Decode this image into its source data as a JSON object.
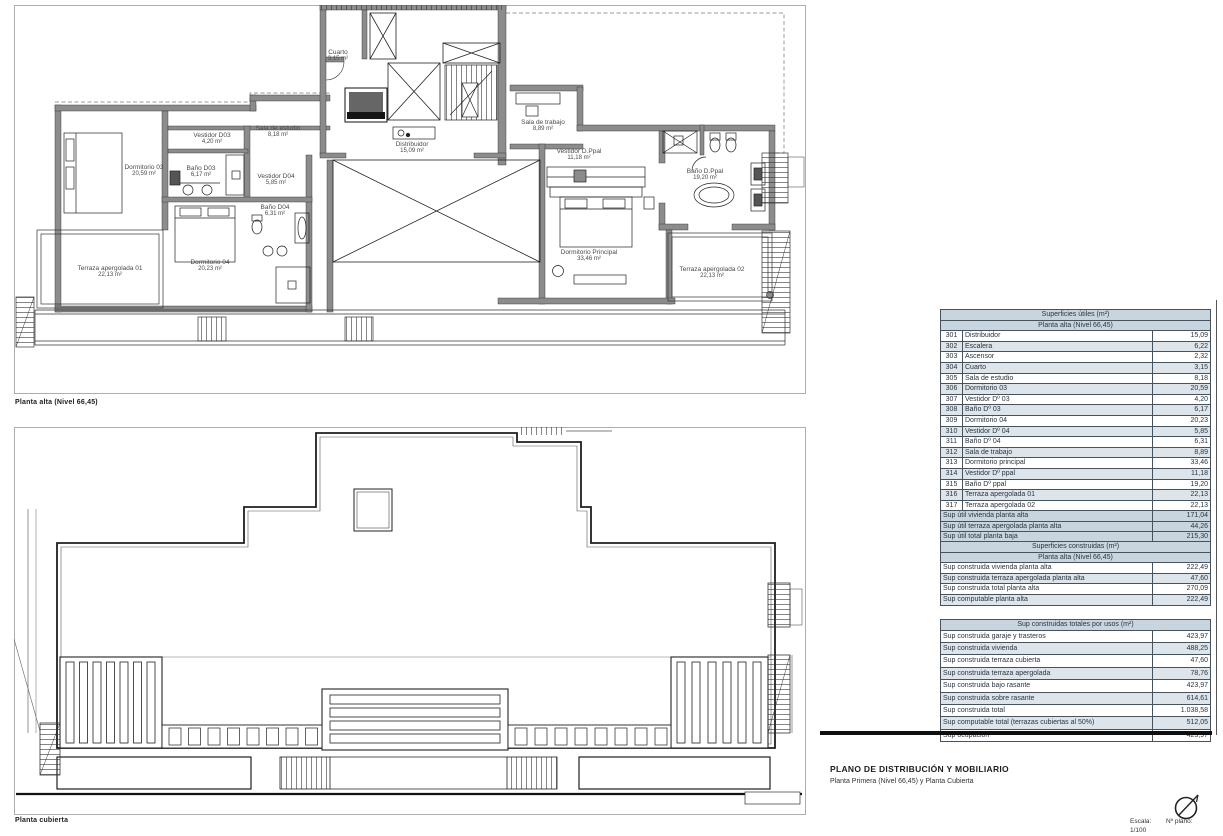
{
  "document": {
    "title": "PLANO DE DISTRIBUCIÓN Y MOBILIARIO",
    "subtitle": "Planta Primera (Nivel 66,45) y Planta Cubierta",
    "scale_label": "Escala:",
    "scale_value": "1/100",
    "plan_number_label": "Nº plano:"
  },
  "plans": {
    "upper": {
      "caption": "Planta alta (Nivel 66,45)"
    },
    "roof": {
      "caption": "Planta cubierta"
    }
  },
  "rooms": [
    {
      "name": "Dormitorio 03",
      "area": "20,59 m²"
    },
    {
      "name": "Vestidor D03",
      "area": "4,20 m²"
    },
    {
      "name": "Baño D03",
      "area": "6,17 m²"
    },
    {
      "name": "Sala de estudio",
      "area": "8,18 m²"
    },
    {
      "name": "Vestidor D04",
      "area": "5,85 m²"
    },
    {
      "name": "Baño D04",
      "area": "6,31 m²"
    },
    {
      "name": "Dormitorio 04",
      "area": "20,23 m²"
    },
    {
      "name": "Terraza apergolada 01",
      "area": "22,13 m²"
    },
    {
      "name": "Cuarto",
      "area": "3,15 m²"
    },
    {
      "name": "Distribuidor",
      "area": "15,09 m²"
    },
    {
      "name": "Sala de trabajo",
      "area": "8,89 m²"
    },
    {
      "name": "Vestidor D.Ppal",
      "area": "11,18 m²"
    },
    {
      "name": "Baño D.Ppal",
      "area": "19,20 m²"
    },
    {
      "name": "Dormitorio Principal",
      "area": "33,46 m²"
    },
    {
      "name": "Terraza apergolada 02",
      "area": "22,13 m²"
    }
  ],
  "tables": {
    "useful": {
      "title": "Superficies útiles (m²)",
      "subtitle": "Planta alta (Nivel 66,45)",
      "rows": [
        [
          "301",
          "Distribuidor",
          "15,09"
        ],
        [
          "302",
          "Escalera",
          "6,22"
        ],
        [
          "303",
          "Ascensor",
          "2,32"
        ],
        [
          "304",
          "Cuarto",
          "3,15"
        ],
        [
          "305",
          "Sala de estudio",
          "8,18"
        ],
        [
          "306",
          "Dormitorio 03",
          "20,59"
        ],
        [
          "307",
          "Vestidor Dº 03",
          "4,20"
        ],
        [
          "308",
          "Baño Dº 03",
          "6,17"
        ],
        [
          "309",
          "Dormitorio 04",
          "20,23"
        ],
        [
          "310",
          "Vestidor Dº 04",
          "5,85"
        ],
        [
          "311",
          "Baño Dº 04",
          "6,31"
        ],
        [
          "312",
          "Sala de trabajo",
          "8,89"
        ],
        [
          "313",
          "Dormitorio principal",
          "33,46"
        ],
        [
          "314",
          "Vestidor Dº ppal",
          "11,18"
        ],
        [
          "315",
          "Baño Dº ppal",
          "19,20"
        ],
        [
          "316",
          "Terraza apergolada 01",
          "22,13"
        ],
        [
          "317",
          "Terraza apergolada 02",
          "22,13"
        ]
      ],
      "summary": [
        [
          "Sup útil vivienda planta alta",
          "171,04"
        ],
        [
          "Sup útil terraza apergolada planta alta",
          "44,26"
        ],
        [
          "Sup útil total planta baja",
          "215,30"
        ]
      ]
    },
    "built": {
      "title": "Superficies construidas (m²)",
      "subtitle": "Planta alta (Nivel 66,45)",
      "rows": [
        [
          "Sup construida vivienda planta alta",
          "222,49"
        ],
        [
          "Sup construida terraza apergolada planta alta",
          "47,60"
        ],
        [
          "Sup construida total planta alta",
          "270,09"
        ],
        [
          "Sup computable planta alta",
          "222,49"
        ]
      ]
    },
    "totals": {
      "title": "Sup construidas totales por usos (m²)",
      "rows": [
        [
          "Sup construida garaje y trasteros",
          "423,97"
        ],
        [
          "Sup construida vivienda",
          "488,25"
        ],
        [
          "Sup construida terraza cubierta",
          "47,60"
        ],
        [
          "Sup construida terraza apergolada",
          "78,76"
        ],
        [
          "Sup construida bajo rasante",
          "423,97"
        ],
        [
          "Sup construida sobre rasante",
          "614,61"
        ],
        [
          "Sup construida total",
          "1.038,58"
        ],
        [
          "Sup computable total (terrazas cubiertas al 50%)",
          "512,05"
        ],
        [
          "Sup ocupación",
          "423,97"
        ]
      ]
    }
  },
  "colors": {
    "wall": "#8c8c8c",
    "table_header": "#c9d5de",
    "table_alt": "#dde4ea",
    "line": "#1f1f1f"
  }
}
